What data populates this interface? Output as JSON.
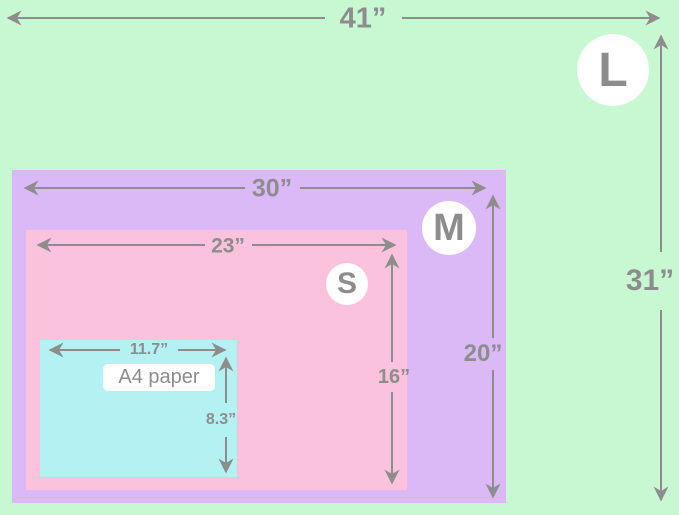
{
  "diagram": {
    "description": "Nested size comparison of poster sizes vs A4 paper",
    "sizes": [
      {
        "code": "L",
        "width_label": "41”",
        "height_label": "31”",
        "color": "#c7f8d1"
      },
      {
        "code": "M",
        "width_label": "30”",
        "height_label": "20”",
        "color": "#dbb8f6"
      },
      {
        "code": "S",
        "width_label": "23”",
        "height_label": "16”",
        "color": "#fac2dd"
      },
      {
        "code": "A4",
        "name": "A4 paper",
        "width_label": "11.7”",
        "height_label": "8.3”",
        "color": "#b4f1f3"
      }
    ],
    "colors": {
      "dimension_gray": "#8d8d8d",
      "badge_background": "#ffffff"
    }
  }
}
